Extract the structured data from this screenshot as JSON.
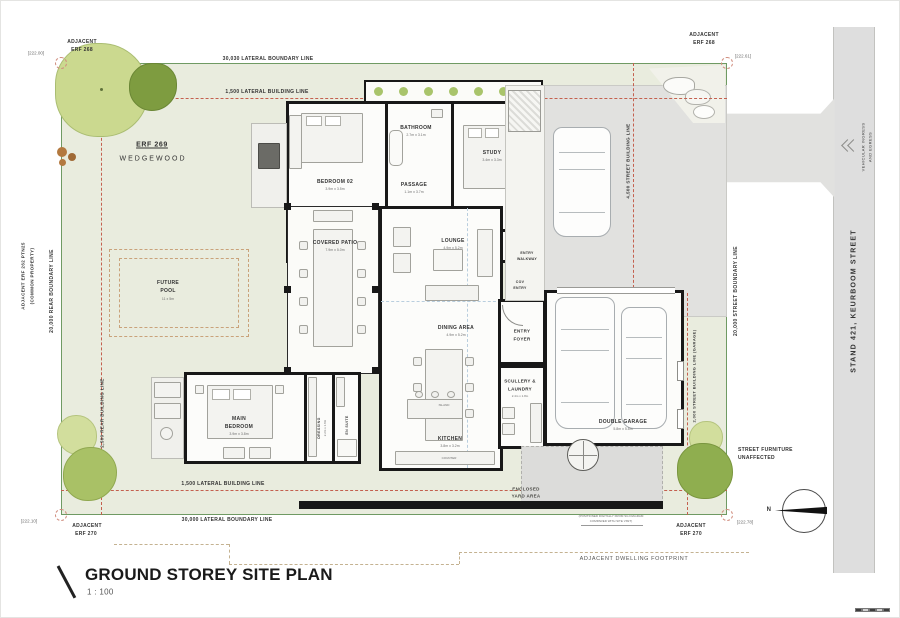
{
  "sheet": {
    "title": "GROUND STOREY SITE PLAN",
    "scale": "1 : 100"
  },
  "site": {
    "erf": "ERF 269",
    "suburb": "WEDGEWOOD"
  },
  "levels": {
    "top_left": "[222.00]",
    "top_right": "[222.61]",
    "bottom_left": "[222.10]",
    "bottom_right": "[222.78]"
  },
  "neighbors": {
    "top_left_1": "ADJACENT",
    "top_left_2": "ERF 268",
    "top_right_1": "ADJACENT",
    "top_right_2": "ERF 268",
    "bottom_left_1": "ADJACENT",
    "bottom_left_2": "ERF 270",
    "bottom_right_1": "ADJACENT",
    "bottom_right_2": "ERF 270",
    "left_1": "ADJACENT ERF 262 PTN25",
    "left_2": "(COMMON PROPERTY)"
  },
  "boundaries": {
    "top_boundary": "30,030   LATERAL BOUNDARY LINE",
    "top_building": "1,500   LATERAL BUILDING LINE",
    "bottom_boundary": "30,000   LATERAL BOUNDARY LINE",
    "bottom_building": "1,500   LATERAL BUILDING LINE",
    "rear_boundary": "20,000   REAR BOUNDARY LINE",
    "rear_building": "2,500   REAR BUILDING LINE",
    "street_boundary": "20,000   STREET BOUNDARY LINE",
    "street_building": "4,500   STREET BUILDING LINE",
    "garage_building": "2,000   STREET BUILDING LINE (GARAGE)"
  },
  "street": {
    "stand": "STAND 421, KEURBOOM STREET",
    "ingress_1": "VEHICULAR INGRESS",
    "ingress_2": "AND EGRESS"
  },
  "rooms": {
    "bedroom02": {
      "name": "BEDROOM 02",
      "dims": "3.9m x 3.5m"
    },
    "bathroom": {
      "name": "BATHROOM",
      "dims": "2.7m x 3.1m"
    },
    "study": {
      "name": "STUDY",
      "dims": "3.4m x 3.3m"
    },
    "passage": {
      "name": "PASSAGE",
      "dims": "1.1m x 3.7m"
    },
    "covered_patio": {
      "name": "COVERED PATIO",
      "dims": "7.9m x 5.0m"
    },
    "lounge": {
      "name": "LOUNGE",
      "dims": "4.9m x 5.2m"
    },
    "dining": {
      "name": "DINING AREA",
      "dims": "4.9m x 5.2m"
    },
    "entry_foyer": {
      "line1": "ENTRY",
      "line2": "FOYER"
    },
    "entry_walkway": {
      "line1": "ENTRY",
      "line2": "WALKWAY"
    },
    "cov_entry": {
      "line1": "COV",
      "line2": "ENTRY"
    },
    "main_bedroom": {
      "line1": "MAIN",
      "line2": "BEDROOM",
      "dims": "3.9m x 3.8m"
    },
    "dressing": {
      "name": "DRESSING",
      "dims": "2.2m x 1.8m"
    },
    "en_suite": {
      "name": "EN SUITE",
      "dims": "2.2m x 1.8m"
    },
    "kitchen": {
      "name": "KITCHEN",
      "dims": "3.8m x 3.2m"
    },
    "scullery": {
      "line1": "SCULLERY &",
      "line2": "LAUNDRY",
      "dims": "2.4m x 1.8m"
    },
    "garage": {
      "name": "DOUBLE GARAGE",
      "dims": "5.8m x 5.8m"
    },
    "yard": {
      "line1": "ENCLOSED",
      "line2": "YARD AREA"
    },
    "counter": "COUNTER",
    "island": "ISLAND"
  },
  "pool": {
    "line1": "FUTURE",
    "line2": "POOL",
    "dims": "11 x 5m"
  },
  "notes": {
    "street_furniture_1": "STREET FURNITURE",
    "street_furniture_2": "UNAFFECTED",
    "footprint": "ADJACENT DWELLING FOOTPRINT",
    "survey_1": "(POSITIONED DIGITALLY FROM SG DIAGRAM",
    "survey_2": "COMPARED WITH SITE VISIT)"
  },
  "compass": {
    "north": "N"
  },
  "colors": {
    "boundary_green": "#6f9a63",
    "building_line_red": "#c4604f",
    "plot_green": "#e9ecde",
    "paving_gray": "#e1e1df",
    "wall_black": "#181818"
  }
}
